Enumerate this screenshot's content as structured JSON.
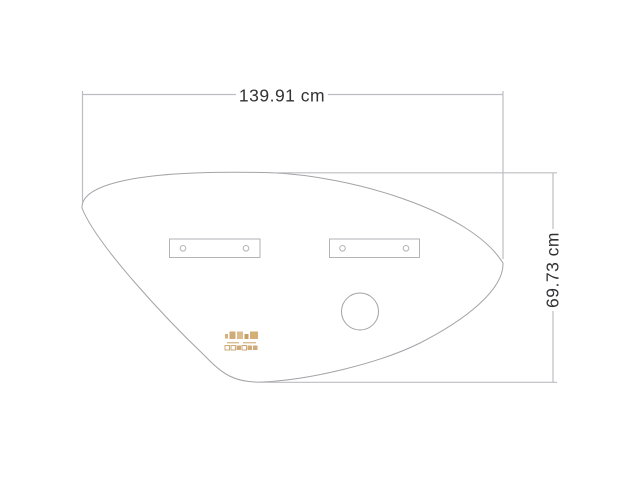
{
  "dimensions": {
    "width_label": "139.91 cm",
    "height_label": "69.73 cm"
  },
  "colors": {
    "outline": "#a3a3a8",
    "dimension_line": "#bdbdc2",
    "bracket_line": "#b2b2b7",
    "label_text": "#333336",
    "logo_accent": "#c9a36b",
    "background": "#ffffff"
  }
}
